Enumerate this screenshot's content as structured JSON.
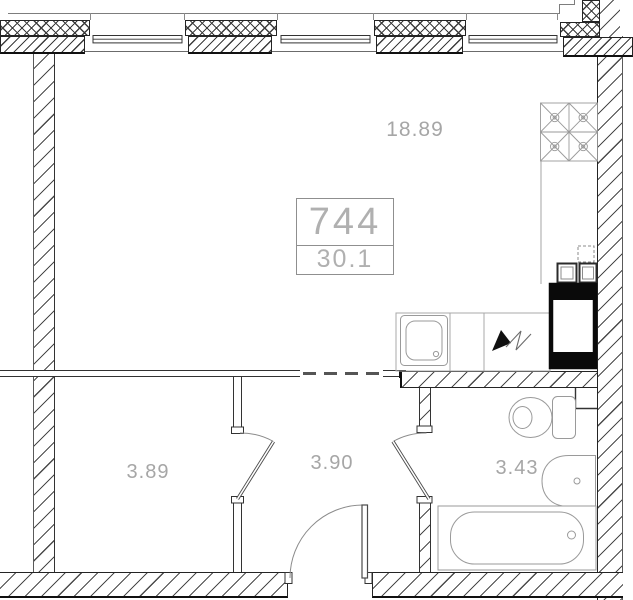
{
  "apartment": {
    "number": "744",
    "total_area": "30.1"
  },
  "rooms": [
    {
      "key": "living_kitchen",
      "area": "18.89"
    },
    {
      "key": "storage",
      "area": "3.89"
    },
    {
      "key": "hallway",
      "area": "3.90"
    },
    {
      "key": "bathroom",
      "area": "3.43"
    }
  ],
  "fixtures": [
    "window-icon",
    "wall-cabinets-icon",
    "kitchen-sink-icon",
    "counter-icon",
    "electric-stove-symbol-icon",
    "oven-icon",
    "burner-blocks-icon",
    "vent-duct-icon",
    "toilet-icon",
    "washbasin-icon",
    "bathtub-icon",
    "door-arc-icon"
  ],
  "colors": {
    "wall_outline": "#242424",
    "hatch_line": "#4a4a4a",
    "fixture_line": "#9a9a9a",
    "label_text": "#a6a6a6",
    "appliance_black": "#0a0a0a"
  }
}
